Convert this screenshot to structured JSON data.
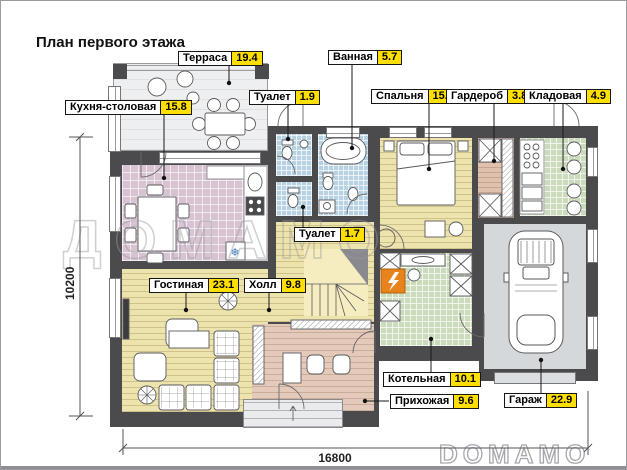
{
  "title": "План первого этажа",
  "rooms": [
    {
      "name": "Терраса",
      "area": "19.4",
      "floor_color": "#edeff1"
    },
    {
      "name": "Кухня-столовая",
      "area": "15.8",
      "floor_color": "#d8c3d3"
    },
    {
      "name": "Туалет",
      "area": "1.9",
      "floor_color": "#b7d3e3"
    },
    {
      "name": "Ванная",
      "area": "5.7",
      "floor_color": "#b7d3e3"
    },
    {
      "name": "Спальня",
      "area": "15.6",
      "floor_color": "#ece3ad"
    },
    {
      "name": "Гардероб",
      "area": "3.8",
      "floor_color": "#dfc1ad"
    },
    {
      "name": "Кладовая",
      "area": "4.9",
      "floor_color": "#cbdcbc"
    },
    {
      "name": "Туалет",
      "area": "1.7",
      "floor_color": "#b7d3e3"
    },
    {
      "name": "Гостиная",
      "area": "23.1",
      "floor_color": "#ece3ad"
    },
    {
      "name": "Холл",
      "area": "9.8",
      "floor_color": "#ece3ad"
    },
    {
      "name": "Котельная",
      "area": "10.1",
      "floor_color": "#cbdcbc"
    },
    {
      "name": "Прихожая",
      "area": "9.6",
      "floor_color": "#e3cabb"
    },
    {
      "name": "Гараж",
      "area": "22.9",
      "floor_color": "#d4d8db"
    }
  ],
  "dimensions": {
    "overall_width_mm": "16800",
    "overall_height_mm": "10200"
  },
  "watermark": {
    "center": "ДОМАМО",
    "corner": "DOMAMO"
  },
  "icons": {
    "fridge": "❄"
  },
  "colors": {
    "wall": "#4b4b4e",
    "area_badge": "#ffdf00",
    "boiler_accent": "#e8821a"
  }
}
